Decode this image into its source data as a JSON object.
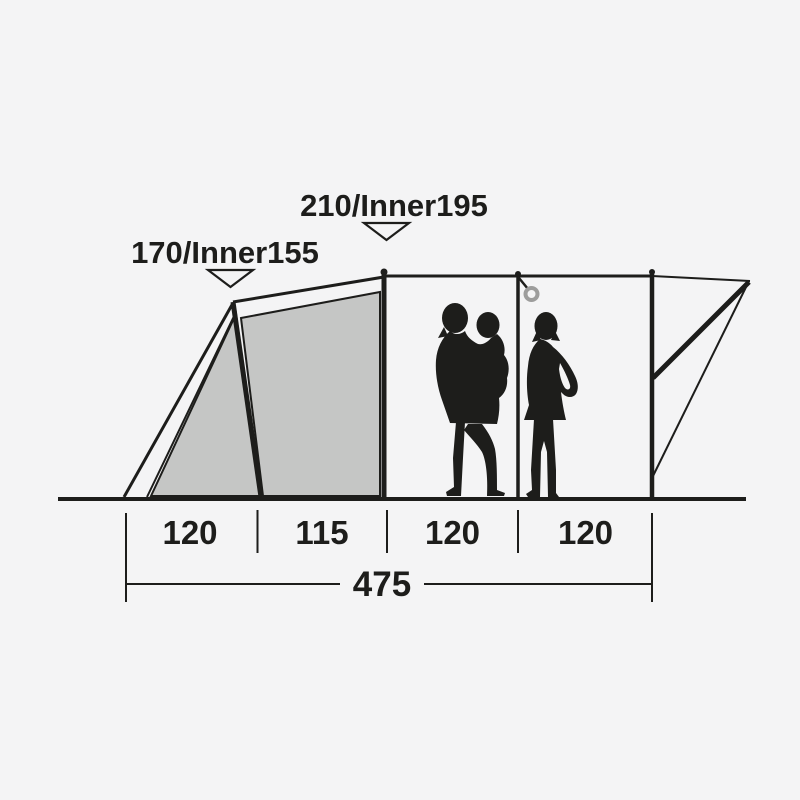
{
  "meta": {
    "type": "tent-cross-section-dimension-diagram"
  },
  "diagram": {
    "height_markers": [
      {
        "label": "170/Inner155",
        "arrow_icon": "triangle-down"
      },
      {
        "label": "210/Inner195",
        "arrow_icon": "triangle-down"
      }
    ],
    "bottom_dimensions": {
      "segments": [
        "120",
        "115",
        "120",
        "120"
      ],
      "total": "475"
    },
    "figures": [
      {
        "name": "adult-holding-child-silhouette"
      },
      {
        "name": "woman-standing-silhouette"
      }
    ],
    "details": [
      {
        "name": "hanging-ring-icon"
      }
    ],
    "colors": {
      "background": "#f4f4f5",
      "line": "#1d1d1b",
      "fabric": "#c5c6c5",
      "ring": "#9d9d9c",
      "silhouette": "#1d1d1b"
    }
  }
}
